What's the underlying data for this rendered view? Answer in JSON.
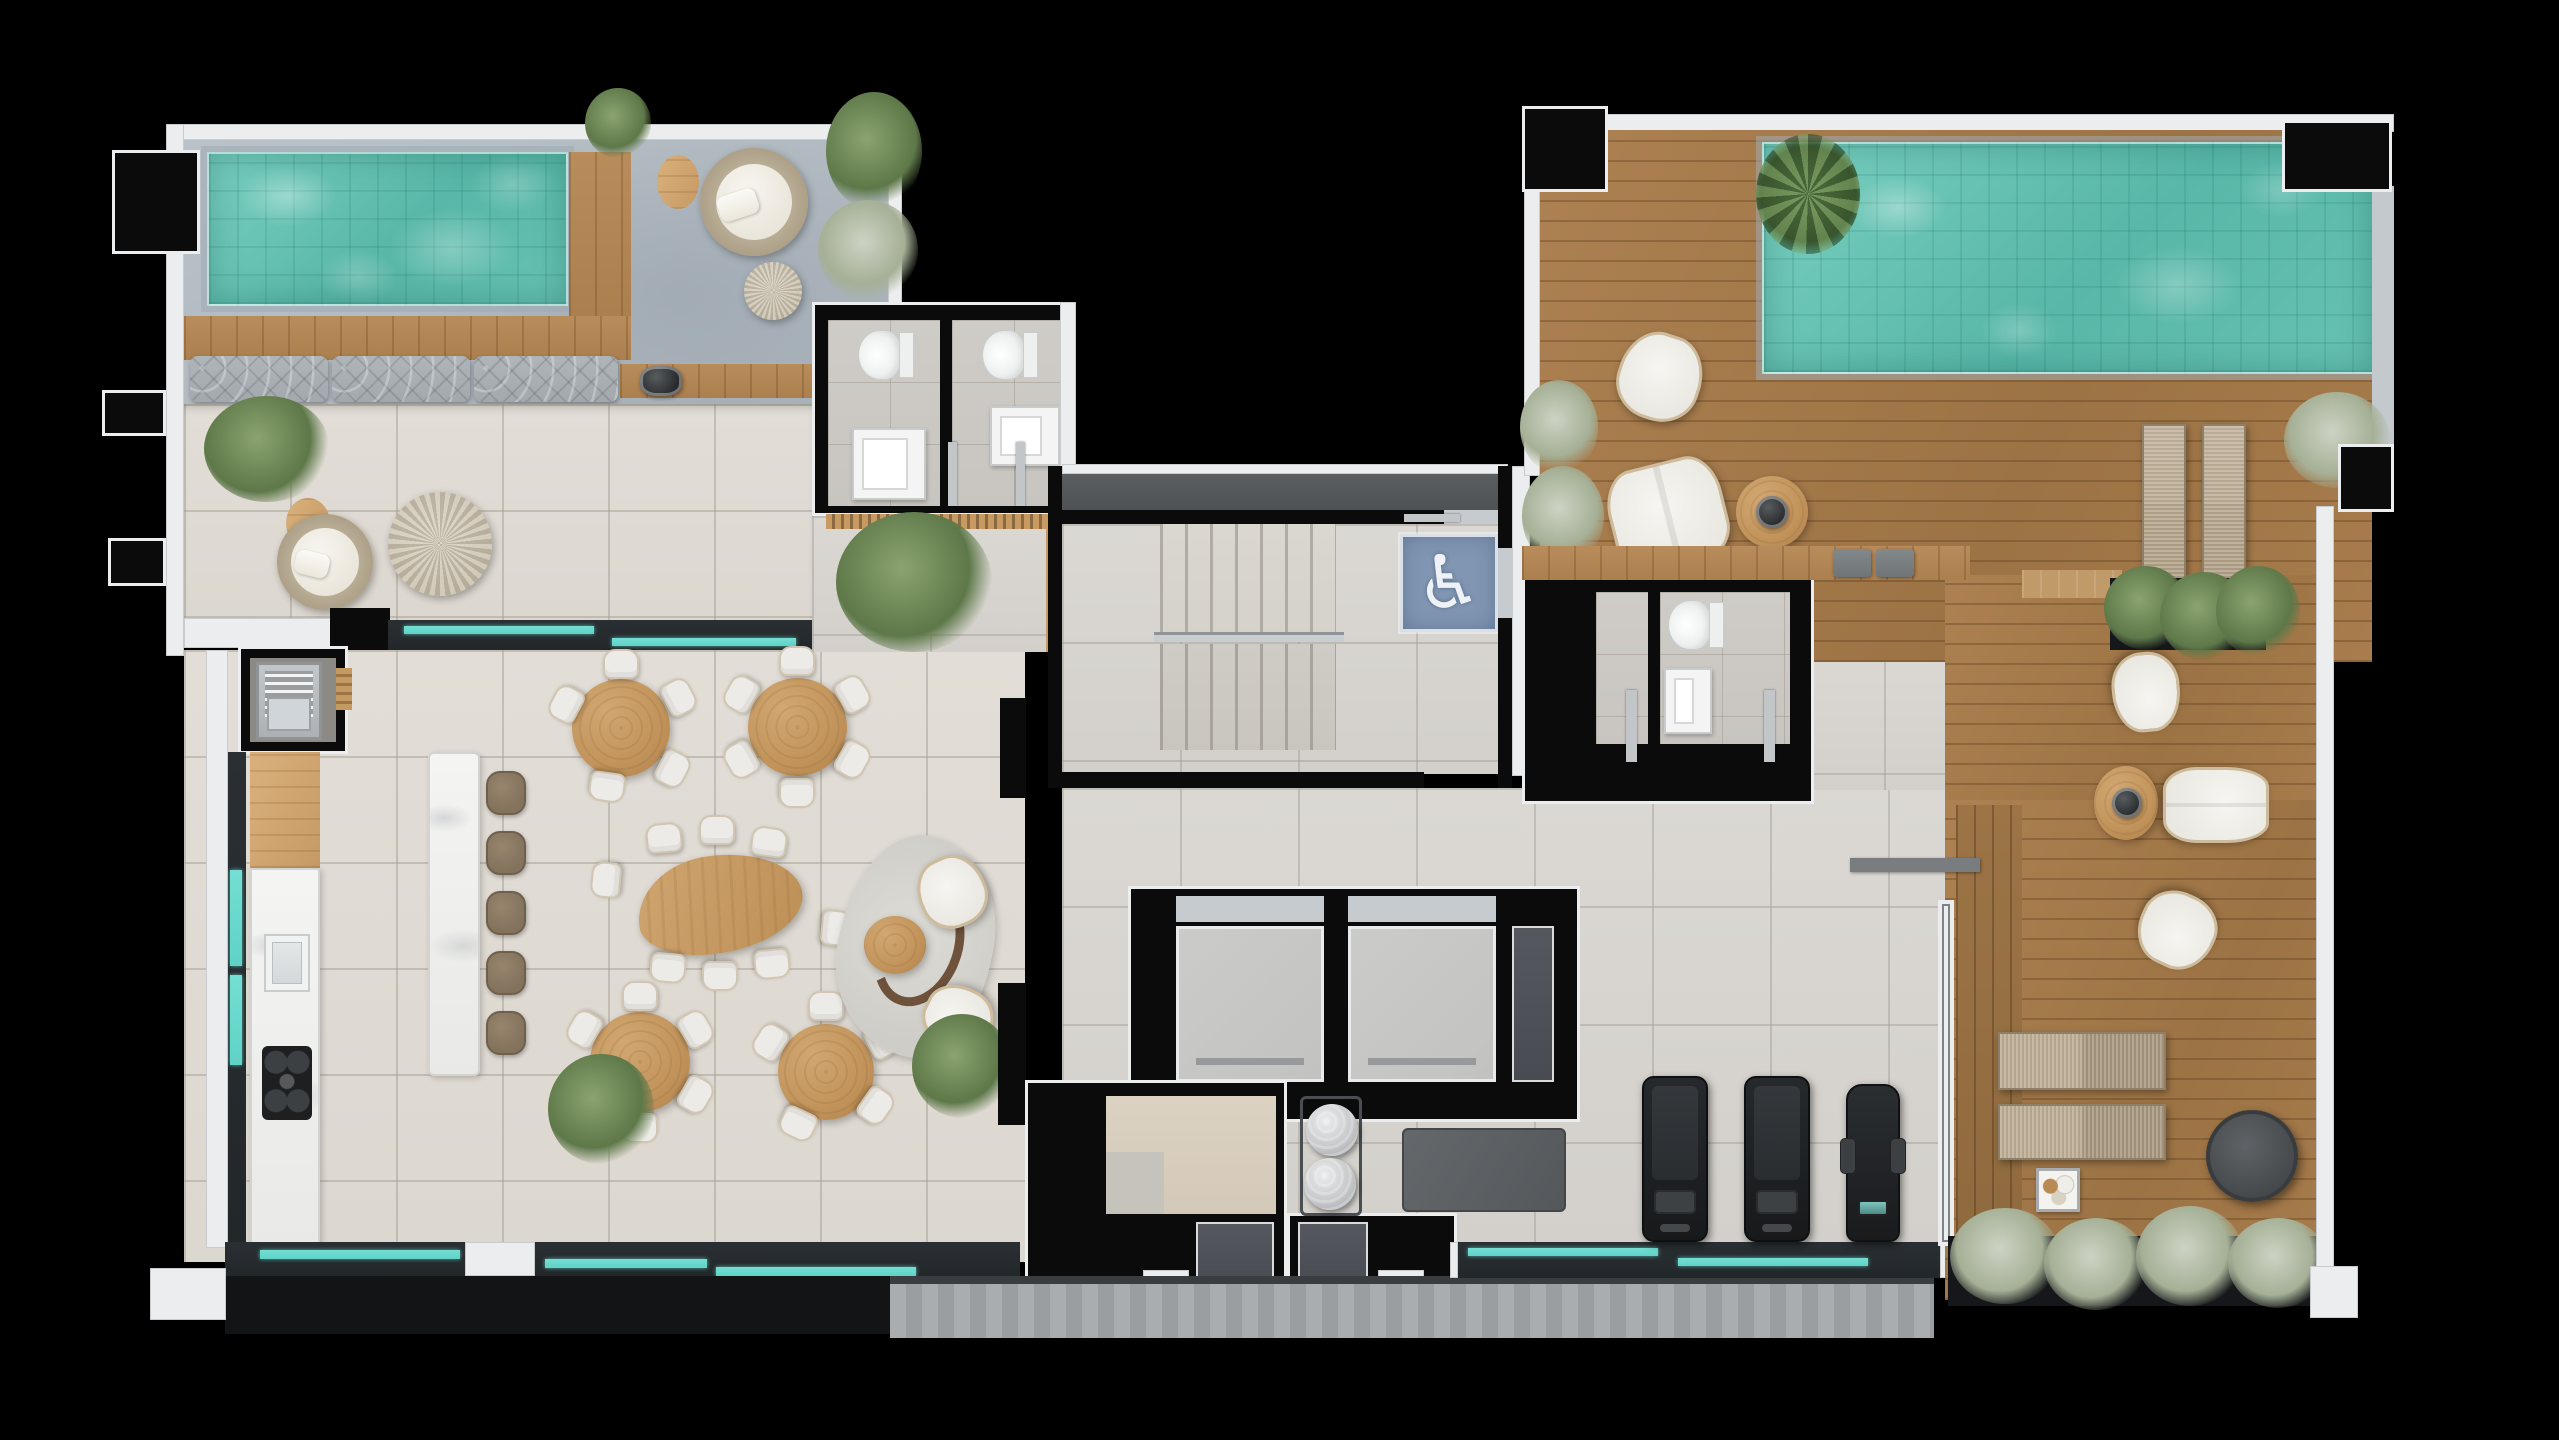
{
  "canvas": {
    "width": 2559,
    "height": 1440,
    "background": "#000000"
  },
  "palette": {
    "bg": "#000000",
    "wall": "#0b0b0c",
    "outline": "#ecedee",
    "pool": "#58b7a8",
    "teal": "#5fd2c6",
    "wood": "#b18355",
    "table": "#c2945c",
    "chair": "#edebe7",
    "sign": "#8096b2"
  },
  "icons": {
    "accessible": {
      "name": "wheelchair-icon",
      "glyph": "♿"
    }
  }
}
